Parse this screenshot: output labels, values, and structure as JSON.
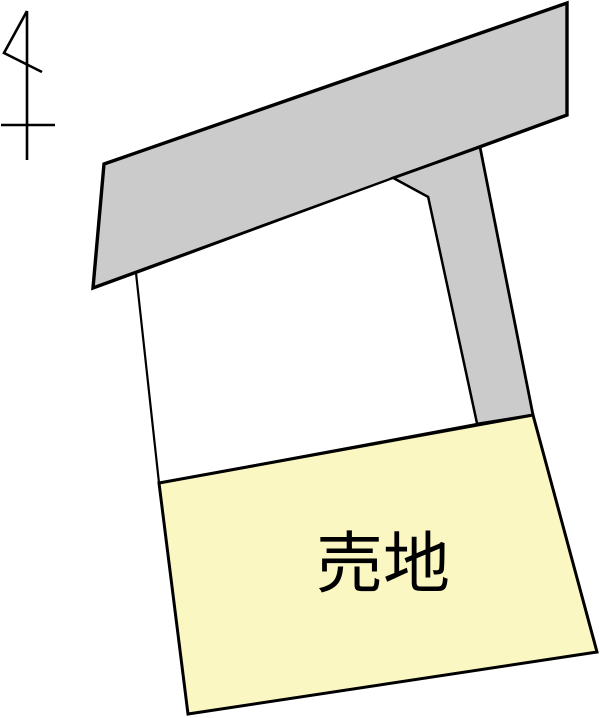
{
  "colors": {
    "background": "#ffffff",
    "road_fill": "#cbcbcb",
    "vacant_fill": "#ffffff",
    "sale_fill": "#faf7c2",
    "outline": "#000000",
    "label": "#000000"
  },
  "label": {
    "text": "売地"
  },
  "shapes": {
    "road_band": {
      "points": "104,164 567,3 567,115 93,288"
    },
    "road_branch": {
      "points": "393,178 480,147 533,415 477,424 428,197"
    },
    "vacant_plot": {
      "points": "136,273 393,178 428,197 477,424 159,483"
    },
    "sale_plot": {
      "points": "159,483 533,415 597,652 188,714"
    },
    "north_arrow": {
      "flag": "27,11 4,53 42,72",
      "staff": "27,11 27,160",
      "crossbar": "1,125 55,125"
    }
  }
}
